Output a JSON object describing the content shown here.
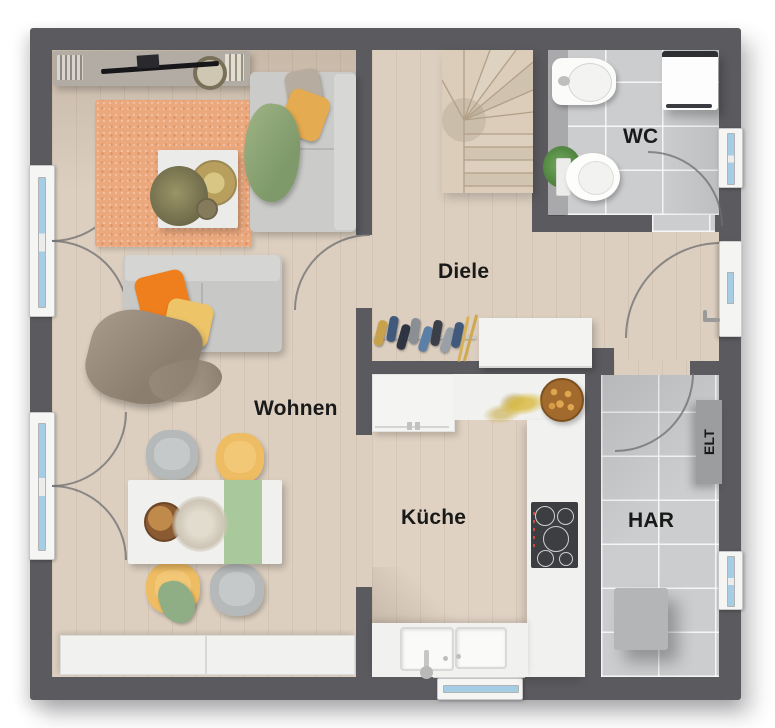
{
  "rooms": {
    "wohnen": {
      "label": "Wohnen"
    },
    "diele": {
      "label": "Diele"
    },
    "wc": {
      "label": "WC"
    },
    "kueche": {
      "label": "Küche"
    },
    "har": {
      "label": "HAR"
    },
    "elt": {
      "label": "ELT"
    }
  },
  "colors": {
    "wall": "#5b5b5f",
    "wood_floor": "#dccfc0",
    "tile_floor": "#cbcdce",
    "rug": "#eba87d",
    "accent_orange": "#ef7e1d",
    "accent_yellow": "#e8b45c",
    "accent_green": "#97ad7f",
    "window_glass": "#a6cde6",
    "label_text": "#191919"
  }
}
